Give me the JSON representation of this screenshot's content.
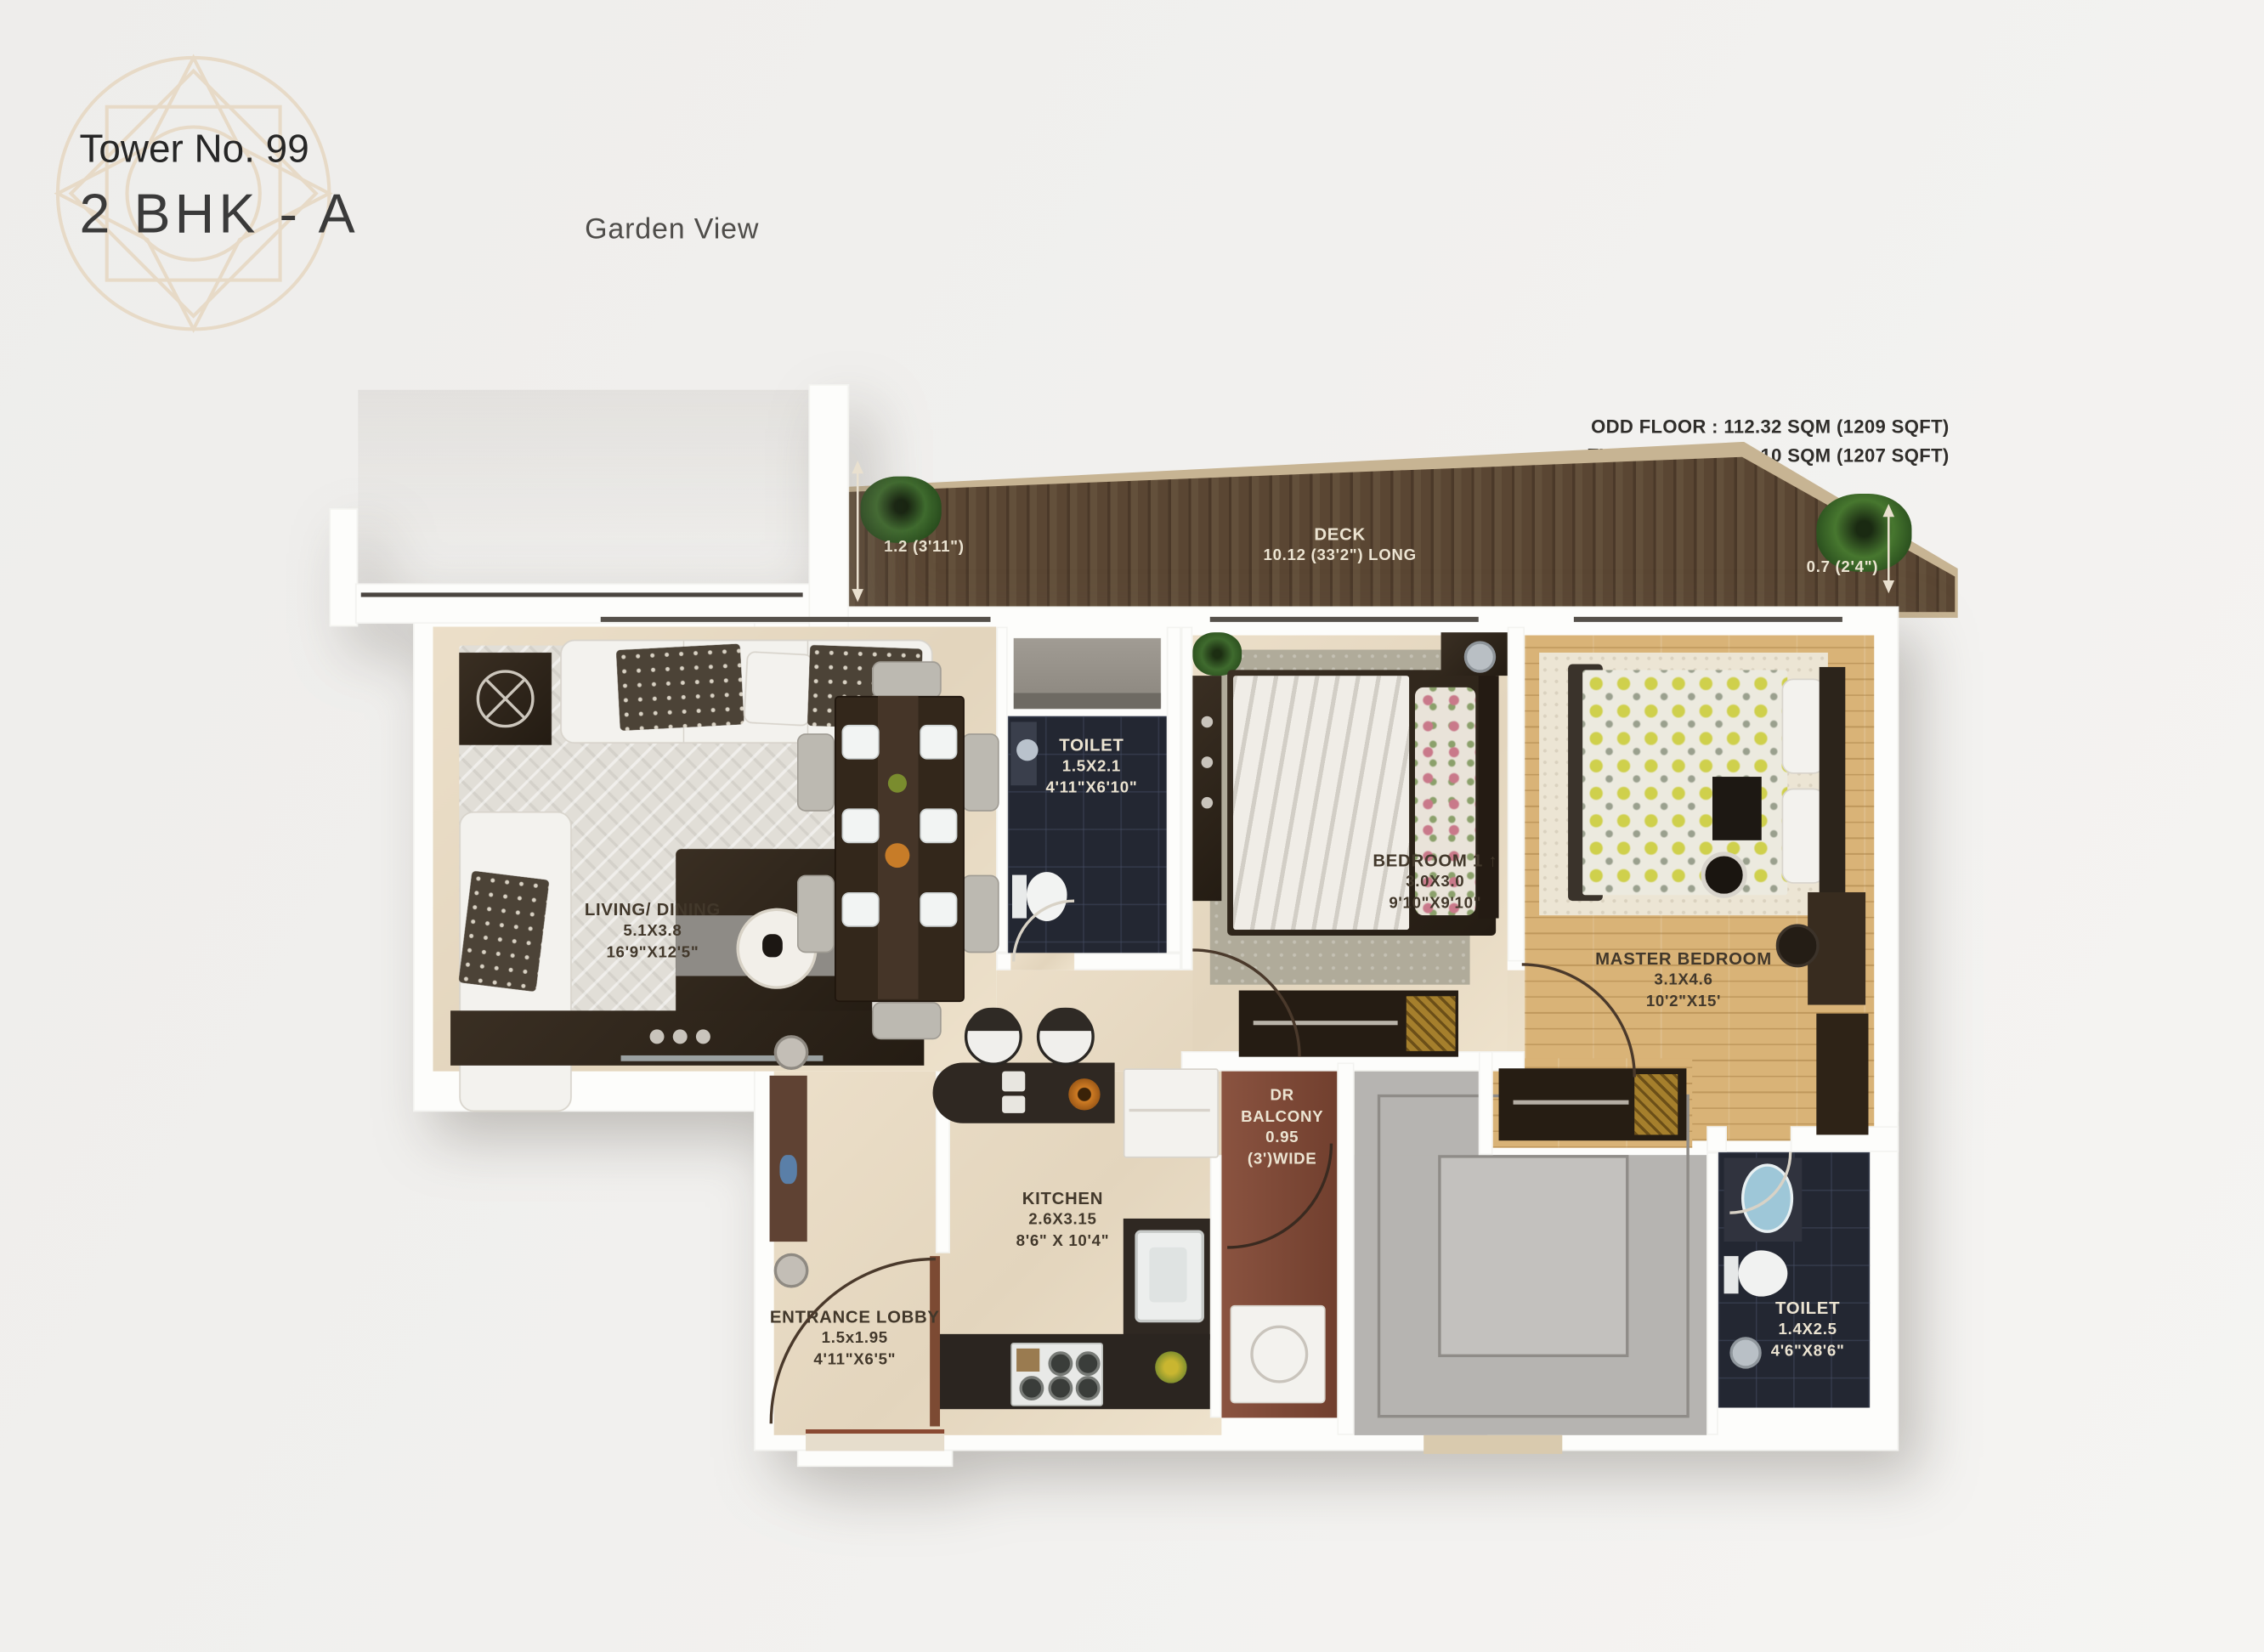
{
  "header": {
    "tower": "Tower No. 99",
    "unit_type": "2 BHK - A",
    "view_label": "Garden View",
    "odd_floor": "ODD FLOOR : 112.32 SQM (1209 SQFT)",
    "even_floor": "EVEN FLOOR: 112.10 SQM (1207 SQFT)"
  },
  "deck": {
    "name": "DECK",
    "length_label": "10.12 (33'2\") LONG",
    "left_width": "1.2 (3'11\")",
    "right_width": "0.7 (2'4\")"
  },
  "rooms": {
    "living_dining": {
      "name": "LIVING/ DINING",
      "size_m": "5.1X3.8",
      "size_ft": "16'9\"X12'5\""
    },
    "toilet_1": {
      "name": "TOILET",
      "size_m": "1.5X2.1",
      "size_ft": "4'11\"X6'10\""
    },
    "bedroom_1": {
      "name": "BEDROOM 1",
      "north_arrow": "↑",
      "size_m": "3.0X3.0",
      "size_ft": "9'10\"X9'10\""
    },
    "master_bedroom": {
      "name": "MASTER BEDROOM",
      "size_m": "3.1X4.6",
      "size_ft": "10'2\"X15'"
    },
    "kitchen": {
      "name": "KITCHEN",
      "size_m": "2.6X3.15",
      "size_ft": "8'6\" X 10'4\""
    },
    "entrance_lobby": {
      "name": "ENTRANCE LOBBY",
      "size_m": "1.5x1.95",
      "size_ft": "4'11\"X6'5\""
    },
    "toilet_2": {
      "name": "TOILET",
      "size_m": "1.4X2.5",
      "size_ft": "4'6\"X8'6\""
    },
    "dr_balcony": {
      "line1": "DR",
      "line2": "BALCONY",
      "line3": "0.95",
      "line4": "(3')WIDE"
    }
  },
  "colors": {
    "background": "#f0efed",
    "wall": "#fdfdfb",
    "floor_beige": "#e7dac3",
    "deck_wood": "#54402e",
    "deck_border": "#c7b493",
    "dr_balcony": "#7c4937",
    "master_wood": "#d9b377",
    "toilet_tile": "#232732",
    "shaft_gray": "#b6b4b1",
    "logo_outline": "#e7dac7",
    "label_dark": "#42382b",
    "label_light": "#ece4d2"
  }
}
